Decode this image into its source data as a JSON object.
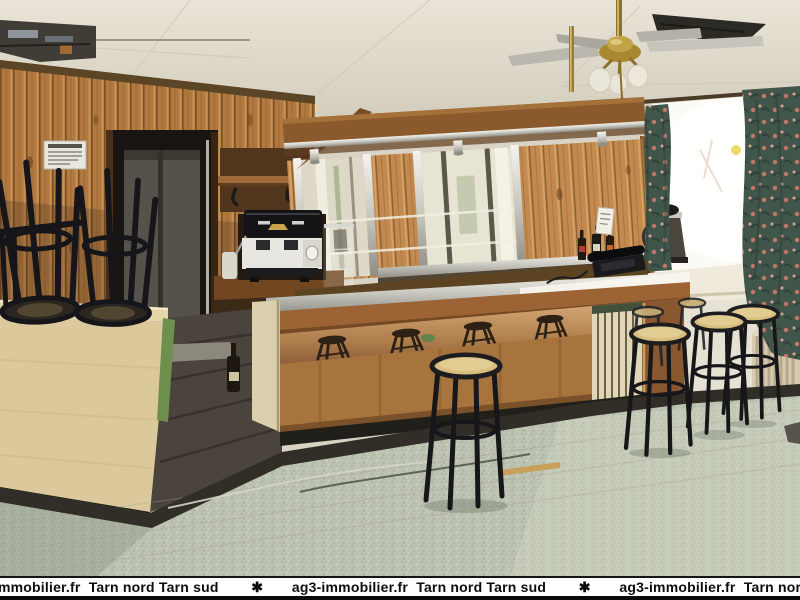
{
  "scene": {
    "description": "Interior photograph of an empty bar-cafe for sale: wood panelled walls, central wooden bar with chrome top and mirrored back-bar under a canopy, black bar stools with beige seats on a speckled tile floor, ceiling fan with globe lights, bright window with dark floral curtains and a radiator on the right, espresso machine and upturned stools stacked on a pale side counter on the left, dark doorway at rear left.",
    "colors": {
      "wood": "#a8713c",
      "wood_dark": "#7a4a24",
      "pale_counter": "#dcc99b",
      "floor_tile": "#bcc2b1",
      "curtain_green": "#41564b",
      "stool_seat": "#d8bd7e",
      "ceiling_cream": "#e3ded0",
      "plinth_black": "#211f1a"
    }
  },
  "watermark": {
    "agency_site": "ag3-immobilier.fr",
    "regions": "Tarn nord Tarn sud",
    "separator": "✱",
    "display_text": "mmobilier.fr  Tarn nord Tarn sud        ✱       ag3-immobilier.fr  Tarn nord Tarn sud        ✱       ag3-immobilier.fr  Tarn nord Tarn s"
  }
}
